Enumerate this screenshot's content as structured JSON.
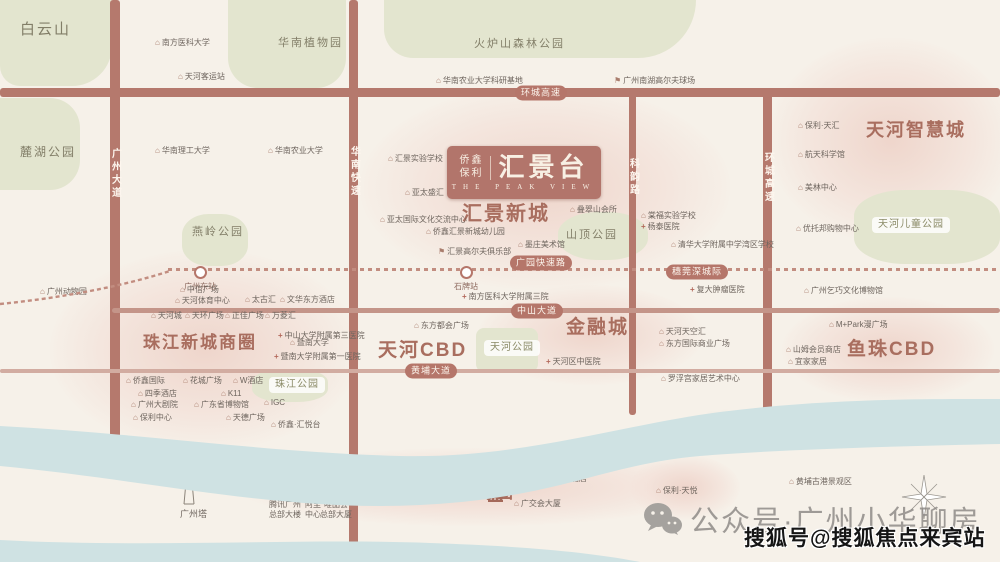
{
  "logo": {
    "brand_top": "侨鑫",
    "brand_bottom": "保利",
    "name": "汇景台",
    "subtitle": "THE PEAK VIEW"
  },
  "river": {
    "name_left": "珠",
    "name_right": "江",
    "left_x": 710,
    "left_y": 407,
    "right_x": 831,
    "right_y": 407
  },
  "watermark": {
    "wechat_label": "公众号·广州小华聊房",
    "sohu_label": "搜狐号@搜狐焦点来宾站"
  },
  "landmarks": {
    "canton_tower": "广州塔",
    "pazhou_complex": "琶洲会展中心"
  },
  "colors": {
    "road": "#b5796d",
    "road_light": "#c49589",
    "road_faint": "#d2aca1",
    "badge": "#b5766a",
    "park": "#e3e5cf",
    "river": "#cfe2e3",
    "district": "#a96e5f",
    "poi_text": "#6e655e"
  },
  "districts": [
    {
      "label": "汇景新城",
      "x": 462,
      "y": 204,
      "size": 20
    },
    {
      "label": "珠江新城商圈",
      "x": 143,
      "y": 334,
      "size": 17
    },
    {
      "label": "天河CBD",
      "x": 378,
      "y": 341,
      "size": 19
    },
    {
      "label": "金融城",
      "x": 566,
      "y": 318,
      "size": 19
    },
    {
      "label": "鱼珠CBD",
      "x": 847,
      "y": 340,
      "size": 19
    },
    {
      "label": "天河智慧城",
      "x": 866,
      "y": 121,
      "size": 18
    },
    {
      "label": "琶洲商圈",
      "x": 435,
      "y": 483,
      "size": 18
    }
  ],
  "area_labels": [
    {
      "label": "白云山",
      "x": 20,
      "y": 22,
      "size": 15
    },
    {
      "label": "麓湖公园",
      "x": 20,
      "y": 146,
      "size": 12
    },
    {
      "label": "华南植物园",
      "x": 278,
      "y": 38,
      "size": 11
    },
    {
      "label": "火炉山森林公园",
      "x": 474,
      "y": 39,
      "size": 11
    },
    {
      "label": "燕岭公园",
      "x": 192,
      "y": 227,
      "size": 11
    },
    {
      "label": "山顶公园",
      "x": 566,
      "y": 230,
      "size": 11
    }
  ],
  "pills": [
    {
      "label": "天河公园",
      "x": 484,
      "y": 340
    },
    {
      "label": "珠江公园",
      "x": 269,
      "y": 377
    },
    {
      "label": "会展公园",
      "x": 371,
      "y": 485
    },
    {
      "label": "天河儿童公园",
      "x": 872,
      "y": 217
    }
  ],
  "parks": [
    {
      "x": 0,
      "y": 0,
      "w": 112,
      "h": 86,
      "r": "0 0 40px 20px"
    },
    {
      "x": 0,
      "y": 98,
      "w": 80,
      "h": 92,
      "r": "0 30px 30px 0"
    },
    {
      "x": 228,
      "y": 0,
      "w": 118,
      "h": 88,
      "r": "0 0 30px 30px"
    },
    {
      "x": 384,
      "y": 0,
      "w": 312,
      "h": 58,
      "r": "0 0 60px 30px"
    },
    {
      "x": 182,
      "y": 214,
      "w": 66,
      "h": 52,
      "r": "40%"
    },
    {
      "x": 558,
      "y": 212,
      "w": 90,
      "h": 48,
      "r": "45%"
    },
    {
      "x": 476,
      "y": 328,
      "w": 62,
      "h": 44,
      "r": "8px"
    },
    {
      "x": 252,
      "y": 369,
      "w": 76,
      "h": 33,
      "r": "40%"
    },
    {
      "x": 854,
      "y": 190,
      "w": 146,
      "h": 74,
      "r": "35%"
    }
  ],
  "blobs": [
    {
      "x": 360,
      "y": 85,
      "w": 370,
      "h": 205
    },
    {
      "x": 50,
      "y": 250,
      "w": 310,
      "h": 200
    },
    {
      "x": 478,
      "y": 285,
      "w": 225,
      "h": 100
    },
    {
      "x": 782,
      "y": 297,
      "w": 212,
      "h": 105
    },
    {
      "x": 768,
      "y": 38,
      "w": 245,
      "h": 205
    },
    {
      "x": 238,
      "y": 448,
      "w": 475,
      "h": 78
    },
    {
      "x": 630,
      "y": 455,
      "w": 110,
      "h": 65
    }
  ],
  "roads": [
    {
      "x": 0,
      "y": 88,
      "w": 1000,
      "h": 9
    },
    {
      "x": 110,
      "y": 0,
      "w": 10,
      "h": 458
    },
    {
      "x": 349,
      "y": 0,
      "w": 9,
      "h": 562
    },
    {
      "x": 629,
      "y": 92,
      "w": 7,
      "h": 323
    },
    {
      "x": 763,
      "y": 92,
      "w": 9,
      "h": 320
    },
    {
      "x": 112,
      "y": 308,
      "w": 888,
      "h": 5,
      "color": "#c49589"
    },
    {
      "x": 0,
      "y": 369,
      "w": 1000,
      "h": 4,
      "color": "#d2aca1"
    }
  ],
  "dotlines": [
    {
      "x": 168,
      "y": 268,
      "w": 832
    }
  ],
  "road_badges": [
    {
      "label": "环城高速",
      "x": 541,
      "y": 93
    },
    {
      "label": "广园快速路",
      "x": 541,
      "y": 263
    },
    {
      "label": "穗莞深城际",
      "x": 697,
      "y": 272
    },
    {
      "label": "中山大道",
      "x": 537,
      "y": 311
    },
    {
      "label": "黄埔大道",
      "x": 431,
      "y": 371
    }
  ],
  "vertical_road_labels": [
    {
      "label": "广州大道",
      "x": 115,
      "y": 148
    },
    {
      "label": "华南快速",
      "x": 354,
      "y": 146
    },
    {
      "label": "科韵路",
      "x": 633,
      "y": 158
    },
    {
      "label": "环城高速",
      "x": 768,
      "y": 152
    }
  ],
  "stations": [
    {
      "label": "广州东站",
      "x": 200,
      "y": 266
    },
    {
      "label": "石牌站",
      "x": 466,
      "y": 266
    }
  ],
  "pois": [
    {
      "label": "南方医科大学",
      "x": 155,
      "y": 43,
      "icon": "school"
    },
    {
      "label": "天河客运站",
      "x": 178,
      "y": 77,
      "icon": "transport"
    },
    {
      "label": "华南理工大学",
      "x": 155,
      "y": 151,
      "icon": "school"
    },
    {
      "label": "华南农业大学",
      "x": 268,
      "y": 151,
      "icon": "school"
    },
    {
      "label": "华南农业大学科研基地",
      "x": 436,
      "y": 81,
      "icon": "school"
    },
    {
      "label": "广州南湖高尔夫球场",
      "x": 614,
      "y": 81,
      "icon": "golf"
    },
    {
      "label": "汇景实验学校",
      "x": 388,
      "y": 159,
      "icon": "school"
    },
    {
      "label": "亚太盛汇",
      "x": 405,
      "y": 193,
      "icon": "building"
    },
    {
      "label": "亚太国际文化交流中心",
      "x": 380,
      "y": 220,
      "icon": "building"
    },
    {
      "label": "侨鑫汇景新城幼儿园",
      "x": 426,
      "y": 232,
      "icon": "school"
    },
    {
      "label": "汇景高尔夫俱乐部",
      "x": 438,
      "y": 252,
      "icon": "golf"
    },
    {
      "label": "叠翠山会所",
      "x": 570,
      "y": 210,
      "icon": "building"
    },
    {
      "label": "墨庄美术馆",
      "x": 518,
      "y": 245,
      "icon": "museum"
    },
    {
      "label": "保利·天汇",
      "x": 798,
      "y": 126,
      "icon": "brand"
    },
    {
      "label": "航天科学馆",
      "x": 798,
      "y": 155,
      "icon": "museum"
    },
    {
      "label": "美林中心",
      "x": 798,
      "y": 188,
      "icon": "building"
    },
    {
      "label": "优托邦购物中心",
      "x": 796,
      "y": 229,
      "icon": "mall"
    },
    {
      "label": "棠福实验学校",
      "x": 641,
      "y": 216,
      "icon": "school"
    },
    {
      "label": "杨泰医院",
      "x": 641,
      "y": 227,
      "icon": "hospital"
    },
    {
      "label": "清华大学附属中学湾区学校",
      "x": 671,
      "y": 245,
      "icon": "school"
    },
    {
      "label": "广州动物园",
      "x": 40,
      "y": 292,
      "icon": "zoo"
    },
    {
      "label": "中信广场",
      "x": 180,
      "y": 290,
      "icon": "building"
    },
    {
      "label": "天河体育中心",
      "x": 175,
      "y": 301,
      "icon": "stadium"
    },
    {
      "label": "太古汇",
      "x": 245,
      "y": 300,
      "icon": "mall"
    },
    {
      "label": "文华东方酒店",
      "x": 280,
      "y": 300,
      "icon": "hotel"
    },
    {
      "label": "天河城",
      "x": 151,
      "y": 316,
      "icon": "mall"
    },
    {
      "label": "天环广场",
      "x": 185,
      "y": 316,
      "icon": "mall"
    },
    {
      "label": "正佳广场",
      "x": 225,
      "y": 316,
      "icon": "mall"
    },
    {
      "label": "万菱汇",
      "x": 265,
      "y": 316,
      "icon": "mall"
    },
    {
      "label": "中山大学附属第三医院",
      "x": 278,
      "y": 336,
      "icon": "hospital"
    },
    {
      "label": "暨南大学",
      "x": 290,
      "y": 343,
      "icon": "school"
    },
    {
      "label": "暨南大学附属第一医院",
      "x": 274,
      "y": 357,
      "icon": "hospital"
    },
    {
      "label": "侨鑫国际",
      "x": 126,
      "y": 381,
      "icon": "building"
    },
    {
      "label": "花城广场",
      "x": 183,
      "y": 381,
      "icon": "plaza"
    },
    {
      "label": "W酒店",
      "x": 233,
      "y": 381,
      "icon": "hotel"
    },
    {
      "label": "四季酒店",
      "x": 138,
      "y": 394,
      "icon": "hotel"
    },
    {
      "label": "K11",
      "x": 221,
      "y": 394,
      "icon": "mall"
    },
    {
      "label": "广州大剧院",
      "x": 131,
      "y": 405,
      "icon": "museum"
    },
    {
      "label": "广东省博物馆",
      "x": 194,
      "y": 405,
      "icon": "museum"
    },
    {
      "label": "IGC",
      "x": 264,
      "y": 403,
      "icon": "mall"
    },
    {
      "label": "保利中心",
      "x": 133,
      "y": 418,
      "icon": "building"
    },
    {
      "label": "天德广场",
      "x": 226,
      "y": 418,
      "icon": "building"
    },
    {
      "label": "侨鑫·汇悦台",
      "x": 271,
      "y": 425,
      "icon": "brand"
    },
    {
      "label": "南方医科大学附属三院",
      "x": 462,
      "y": 297,
      "icon": "hospital"
    },
    {
      "label": "东方都会广场",
      "x": 414,
      "y": 326,
      "icon": "building"
    },
    {
      "label": "天河区中医院",
      "x": 546,
      "y": 362,
      "icon": "hospital"
    },
    {
      "label": "复大肿瘤医院",
      "x": 690,
      "y": 290,
      "icon": "hospital"
    },
    {
      "label": "广州乞巧文化博物馆",
      "x": 804,
      "y": 291,
      "icon": "museum"
    },
    {
      "label": "天河天空汇",
      "x": 659,
      "y": 332,
      "icon": "building"
    },
    {
      "label": "东方国际商业广场",
      "x": 659,
      "y": 344,
      "icon": "building"
    },
    {
      "label": "罗浮宫家居艺术中心",
      "x": 661,
      "y": 379,
      "icon": "building"
    },
    {
      "label": "M+Park漫广场",
      "x": 829,
      "y": 325,
      "icon": "mall"
    },
    {
      "label": "山姆会员商店",
      "x": 786,
      "y": 350,
      "icon": "mall"
    },
    {
      "label": "宜家家居",
      "x": 788,
      "y": 362,
      "icon": "mall"
    },
    {
      "label": "琶醍啤酒文化创意艺术区",
      "x": 256,
      "y": 482,
      "icon": "scenic"
    },
    {
      "label": "香格里拉大酒店",
      "x": 524,
      "y": 479,
      "icon": "hotel"
    },
    {
      "label": "广交会大厦",
      "x": 514,
      "y": 504,
      "icon": "building"
    },
    {
      "label": "保利·天悦",
      "x": 656,
      "y": 491,
      "icon": "brand"
    },
    {
      "label": "黄埔古港景观区",
      "x": 789,
      "y": 482,
      "icon": "scenic"
    }
  ],
  "hq_towers": [
    {
      "line1": "腾讯广州",
      "line2": "总部大楼",
      "x": 285,
      "y": 488
    },
    {
      "line1": "阿里",
      "line2": "中心",
      "x": 313,
      "y": 488
    },
    {
      "line1": "唯品会",
      "line2": "总部大厦",
      "x": 336,
      "y": 488
    }
  ]
}
